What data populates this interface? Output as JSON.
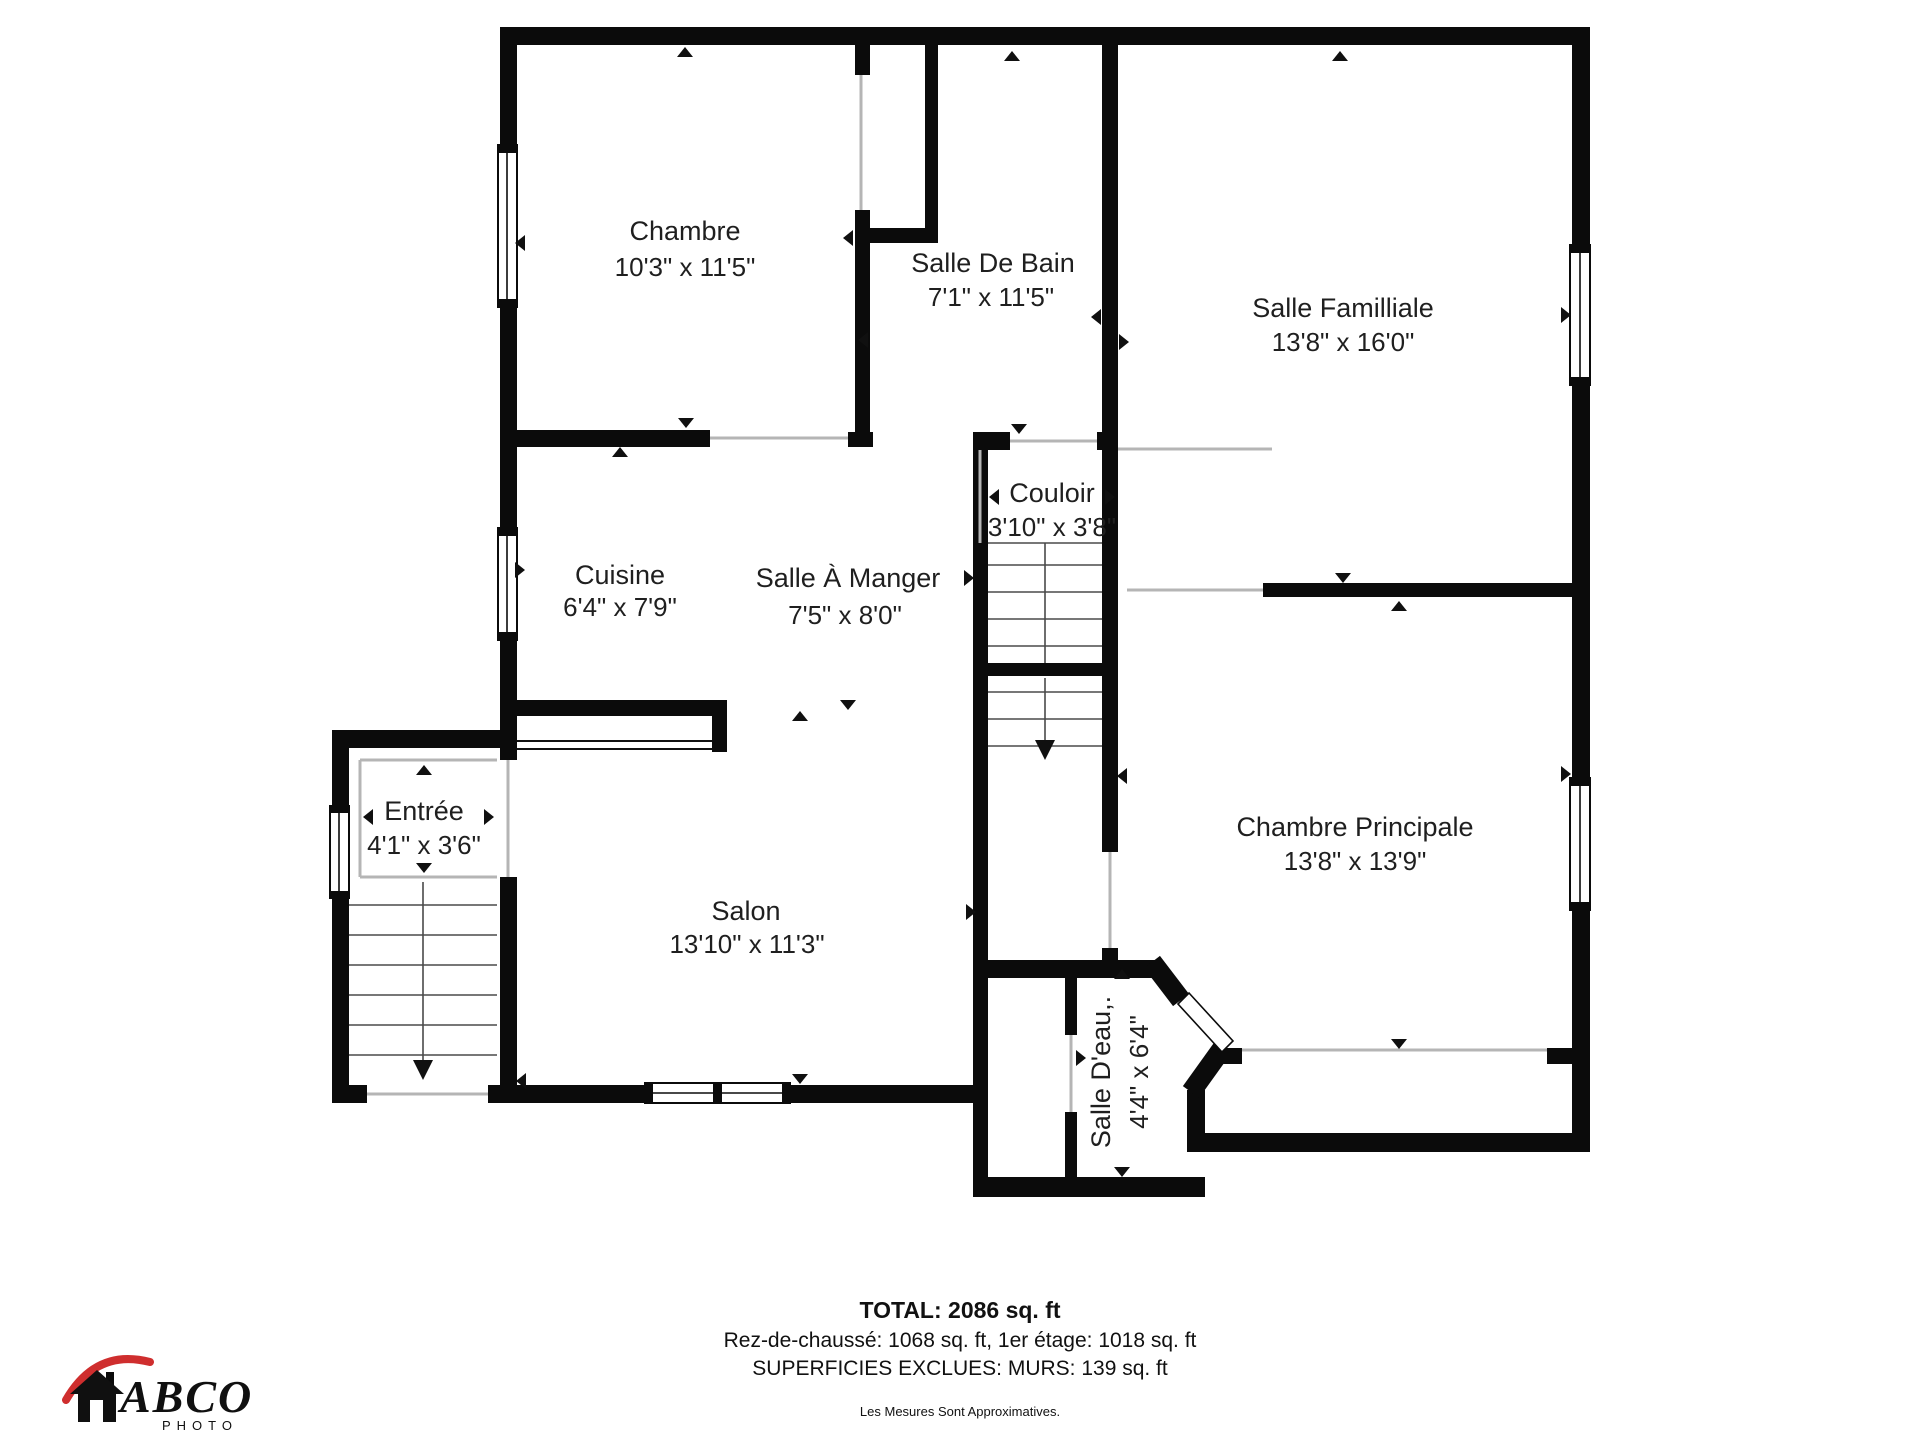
{
  "rooms": [
    {
      "name": "Chambre",
      "dims": "10'3\" x 11'5\""
    },
    {
      "name": "Salle De Bain",
      "dims": "7'1\" x 11'5\""
    },
    {
      "name": "Salle Familliale",
      "dims": "13'8\" x 16'0\""
    },
    {
      "name": "Couloir",
      "dims": "3'10\" x 3'8\""
    },
    {
      "name": "Cuisine",
      "dims": "6'4\" x 7'9\""
    },
    {
      "name": "Salle À Manger",
      "dims": "7'5\" x 8'0\""
    },
    {
      "name": "Entrée",
      "dims": "4'1\" x 3'6\""
    },
    {
      "name": "Salon",
      "dims": "13'10\" x 11'3\""
    },
    {
      "name": "Chambre Principale",
      "dims": "13'8\" x 13'9\""
    },
    {
      "name": "Salle D'eau,.",
      "dims": "4'4\" x 6'4\""
    }
  ],
  "footer": {
    "total": "TOTAL: 2086 sq. ft",
    "floors": "Rez-de-chaussé: 1068 sq. ft, 1er étage: 1018 sq. ft",
    "excluded": "SUPERFICIES EXCLUES: MURS: 139 sq. ft",
    "disclaimer": "Les Mesures Sont Approximatives."
  },
  "logo": {
    "brand": "ABCO",
    "sub": "PHOTO"
  },
  "colors": {
    "wall": "#0b0b0b",
    "paper": "#ffffff",
    "logo_red": "#cf2e2e"
  }
}
